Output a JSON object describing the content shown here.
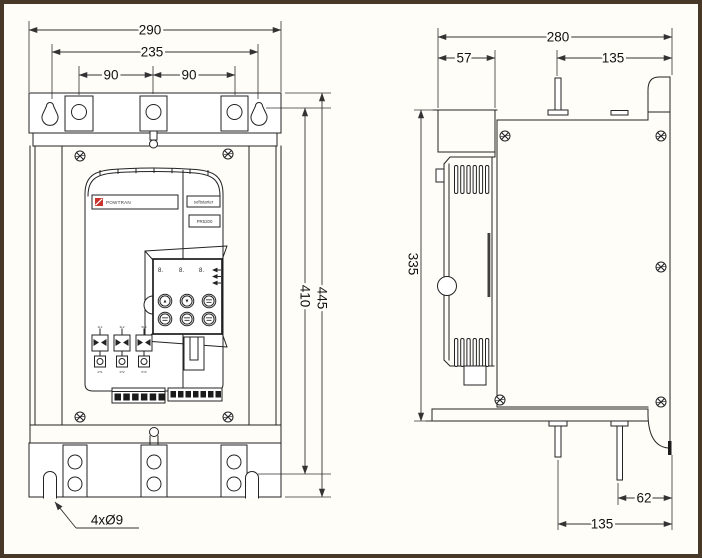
{
  "front": {
    "dim_width_overall": "290",
    "dim_mount_width": "235",
    "dim_hole_spacing_left": "90",
    "dim_hole_spacing_right": "90",
    "dim_mount_height": "410",
    "dim_height_overall": "445",
    "slot_note": "4xØ9",
    "panel": {
      "brand": "POWTRAN",
      "product_label": "softstarter",
      "model_label": "PR5200",
      "digits": [
        "8.",
        "8.",
        "8."
      ],
      "btn_up": "▲",
      "btn_down": "▼",
      "schematic_top": [
        "1L1",
        "3L2",
        "5L3"
      ],
      "schematic_bottom": [
        "2T1",
        "4T2",
        "6T3"
      ]
    }
  },
  "side": {
    "dim_depth_overall": "280",
    "dim_front_depth": "57",
    "dim_pin_top": "135",
    "dim_body_height": "335",
    "dim_pin_offset": "62",
    "dim_pin_bottom": "135"
  },
  "colors": {
    "line": "#232323",
    "accent_red": "#c8332e",
    "frame": "#473828",
    "paper": "#fffdf7"
  }
}
